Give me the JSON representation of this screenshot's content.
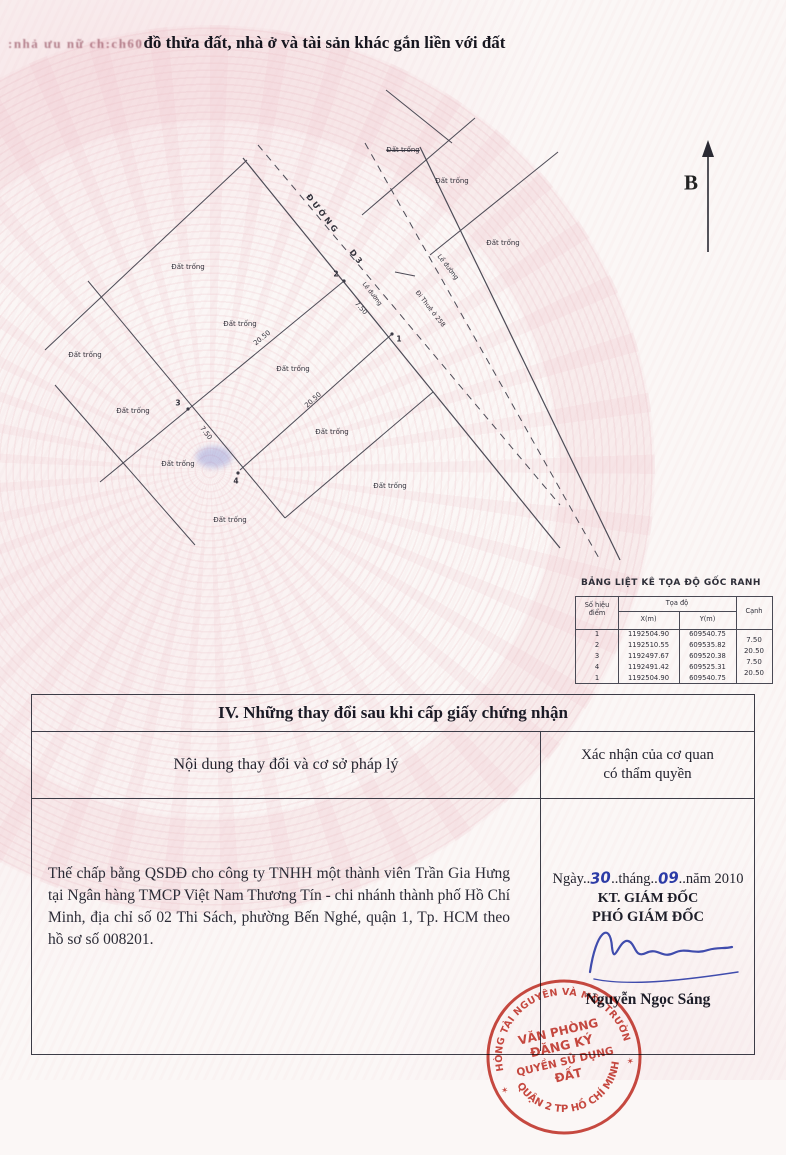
{
  "page": {
    "garbled_prefix": ":nhả ưu nữ ch:ch60",
    "title": "đồ thửa đất, nhà ở và tài sản khác gắn liền với đất"
  },
  "map": {
    "north_label": "B",
    "road_name": "ĐƯỜNG D3",
    "edge_label": "Lề đường",
    "direction_note": "Đi Thuê ở 258",
    "plot_label": "Đất trống",
    "points": {
      "p1": "1",
      "p2": "2",
      "p3": "3",
      "p4": "4"
    },
    "dims": {
      "edge_1_2": "7.50",
      "edge_2_3": "20.50",
      "edge_3_4": "7.50",
      "edge_4_1": "20.50"
    }
  },
  "coord_table": {
    "title": "BẢNG LIỆT KÊ TỌA ĐỘ GỐC RANH",
    "headers": {
      "point_l1": "Số hiệu",
      "point_l2": "điểm",
      "toado": "Tọa độ",
      "x": "X(m)",
      "y": "Y(m)",
      "canh": "Cạnh"
    },
    "rows": [
      {
        "point": "1",
        "x": "1192504.90",
        "y": "609540.75"
      },
      {
        "point": "2",
        "x": "1192510.55",
        "y": "609535.82"
      },
      {
        "point": "3",
        "x": "1192497.67",
        "y": "609520.38"
      },
      {
        "point": "4",
        "x": "1192491.42",
        "y": "609525.31"
      },
      {
        "point": "1",
        "x": "1192504.90",
        "y": "609540.75"
      }
    ],
    "canh_values": [
      "7.50",
      "20.50",
      "7.50",
      "20.50"
    ]
  },
  "section4": {
    "header": "IV. Những thay đổi sau khi cấp giấy chứng nhận",
    "col_left": "Nội dung thay đổi và cơ sở pháp lý",
    "col_right_line1": "Xác nhận của cơ quan",
    "col_right_line2": "có thẩm quyền",
    "content": "Thế chấp bằng QSDĐ cho công ty TNHH một thành viên Trần Gia Hưng tại Ngân hàng TMCP Việt Nam Thương Tín - chi nhánh thành phố Hồ Chí Minh, địa chỉ số 02 Thi Sách, phường Bến Nghé, quận 1, Tp. HCM theo hồ sơ số 008201.",
    "date": {
      "l1": "Ngày..",
      "day": "30",
      "l2": "..tháng..",
      "month": "09",
      "l3": "..năm 2010"
    },
    "kt_line": "KT. GIÁM ĐỐC",
    "deputy_line": "PHÓ GIÁM ĐỐC",
    "signer": "Nguyễn Ngọc Sáng",
    "stamp": {
      "ring_top": "PHÒNG TÀI NGUYÊN VÀ MÔI TRƯỜNG",
      "ring_bottom": "QUẬN 2 TP HỒ CHÍ MINH",
      "star": "✶",
      "center_line1": "VĂN PHÒNG",
      "center_line2": "ĐĂNG KÝ",
      "center_line3": "QUYỀN SỬ DỤNG",
      "center_line4": "ĐẤT"
    }
  },
  "colors": {
    "stamp_red": "#c23228",
    "ink_blue": "#2c3ba6",
    "watermark_pink": "#e2a0aa"
  }
}
